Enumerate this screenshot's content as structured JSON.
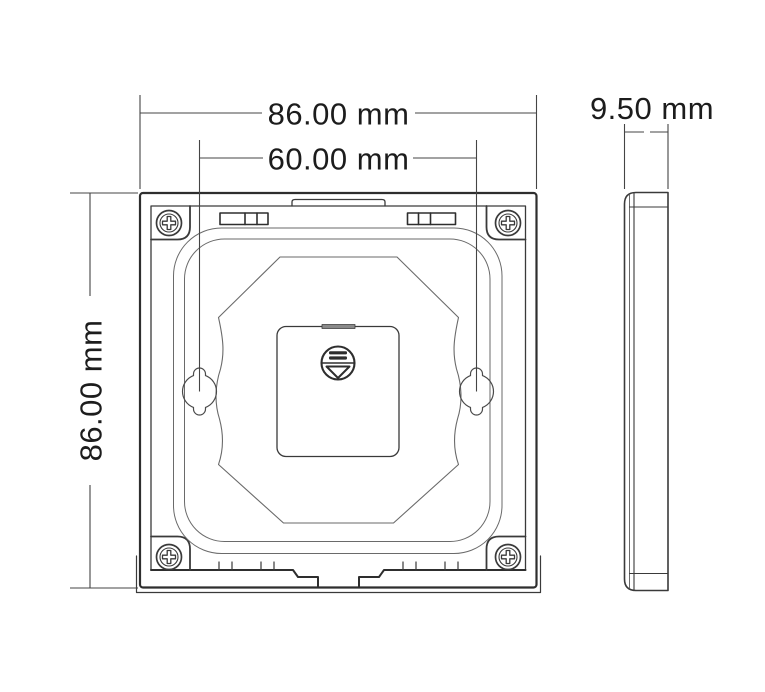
{
  "drawing": {
    "type": "technical-dimension-drawing",
    "subject": "wall-panel-mounting-plate",
    "views": {
      "front": "front-view",
      "side": "side-view"
    }
  },
  "dimensions": {
    "top_width": "86.00 mm",
    "hole_spacing": "60.00 mm",
    "side_height": "86.00 mm",
    "depth": "9.50 mm"
  },
  "icons": {
    "screw": "phillips-screw-icon",
    "release": "release-arrow-icon",
    "keyhole": "keyhole-mount-slot"
  },
  "colors": {
    "background": "#ffffff",
    "line_heavy": "#2e2e2e",
    "line_medium": "#3a3a3a",
    "line_light": "#6a6a6a",
    "text": "#1c1c1c",
    "notch_fill": "#8a8a8a"
  }
}
